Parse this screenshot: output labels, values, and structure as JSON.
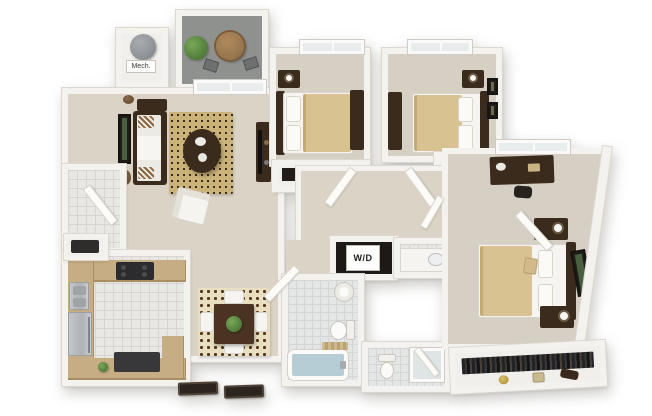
{
  "scene": {
    "type": "3d-floor-plan-render",
    "view": "top-down isometric",
    "bedrooms": 3,
    "bathrooms": 2,
    "background": "#ffffff"
  },
  "labels": {
    "mech": "Mech.",
    "washer_dryer": "W/D"
  },
  "palette": {
    "wall": "#f4f2ee",
    "wall_edge": "#dcd7cf",
    "carpet": "#dbd4c6",
    "carpet_2": "#d6cfc4",
    "tile": "#e8e7e4",
    "tile_line": "#d6d5d1",
    "bath_tile": "#e4e6e5",
    "balcony": "#8f918f",
    "counter": "#c6ad83",
    "counter_dark": "#a98e63",
    "wood": "#3b2b1d",
    "wood_2": "#5d4430",
    "stainless": "#b7babc",
    "black_app": "#2c2c2e",
    "sheet": "#f5f4f0",
    "blanket": "#d8c291",
    "rug": "#cbb279",
    "rug_2": "#e9dec0",
    "plant": "#4f7c3a",
    "tub": "#b6cdd5",
    "mat": "#2b241f",
    "glass": "#e7ecec"
  },
  "rooms": [
    {
      "id": "balcony",
      "floor": "concrete",
      "furniture": [
        "potted-plant",
        "round-bistro-table",
        "patio-chair",
        "patio-chair"
      ]
    },
    {
      "id": "mechanical-closet",
      "label_key": "mech",
      "furniture": [
        "water-heater"
      ]
    },
    {
      "id": "living-room",
      "floor": "carpet",
      "furniture": [
        "sofa",
        "striped-accent-pillows",
        "console-table",
        "wall-art",
        "oval-wall-decor",
        "oval-wall-decor",
        "speckled-area-rug",
        "oval-coffee-table",
        "armchair",
        "tv-console",
        "sliding-glass-door"
      ]
    },
    {
      "id": "dining-area",
      "floor": "carpet",
      "furniture": [
        "damask-rug",
        "square-dining-table",
        "centerpiece-plant",
        "dining-chair",
        "dining-chair",
        "dining-chair",
        "dining-chair"
      ]
    },
    {
      "id": "entry",
      "floor": "tile",
      "furniture": [
        "open-entry-door",
        "door-mat",
        "door-mat"
      ]
    },
    {
      "id": "kitchen",
      "floor": "tile",
      "furniture": [
        "u-shaped-tan-counter",
        "refrigerator",
        "double-sink",
        "black-range",
        "dishwasher",
        "microwave-nook",
        "small-plant"
      ]
    },
    {
      "id": "bedroom-1",
      "floor": "carpet",
      "furniture": [
        "bed",
        "headboard",
        "pillows",
        "tan-blanket",
        "nightstand",
        "lamp",
        "dresser",
        "reach-in-closet",
        "window"
      ]
    },
    {
      "id": "bedroom-2",
      "floor": "carpet",
      "furniture": [
        "bed",
        "headboard",
        "pillows",
        "tan-blanket",
        "nightstand",
        "lamp",
        "dresser",
        "reach-in-closet",
        "window",
        "wall-frame",
        "wall-frame"
      ]
    },
    {
      "id": "hallway",
      "floor": "carpet",
      "furniture": [
        "open-door",
        "open-door",
        "open-door",
        "open-door"
      ]
    },
    {
      "id": "laundry-closet",
      "label_key": "washer_dryer",
      "furniture": [
        "stacked-washer-dryer"
      ]
    },
    {
      "id": "bathroom-1",
      "floor": "bath-tile",
      "furniture": [
        "pedestal-sink",
        "toilet",
        "bathtub",
        "bath-mat",
        "open-door"
      ]
    },
    {
      "id": "bathroom-2",
      "floor": "bath-tile",
      "furniture": [
        "toilet",
        "glass-shower",
        "vanity-counter",
        "vanity-sink",
        "linen-cabinet"
      ]
    },
    {
      "id": "master-bedroom",
      "floor": "carpet",
      "furniture": [
        "bed",
        "headboard",
        "pillows",
        "tan-blanket",
        "nightstand",
        "nightstand",
        "lamp",
        "lamp",
        "desk",
        "desk-chair",
        "wall-art",
        "window",
        "angled-exterior-wall"
      ]
    },
    {
      "id": "master-closet",
      "furniture": [
        "hanging-clothes-rod",
        "gold-hat-box",
        "storage-basket",
        "clutch-box"
      ]
    }
  ]
}
